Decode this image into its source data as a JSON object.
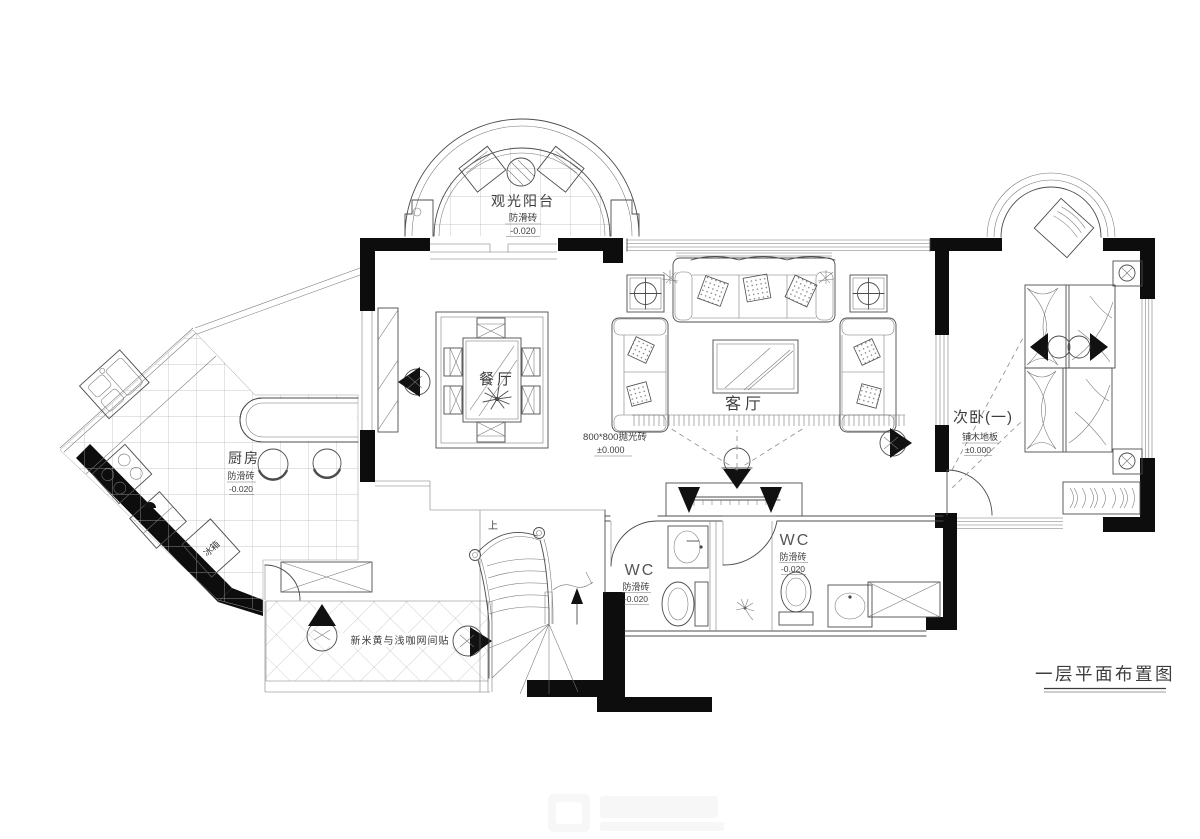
{
  "plan": {
    "title": "一层平面布置图",
    "balcony": {
      "name": "观光阳台",
      "floor": "防滑砖",
      "level": "-0.020"
    },
    "dining": {
      "name": "餐厅"
    },
    "living": {
      "name": "客厅",
      "floor": "800*800抛光砖",
      "level": "±0.000"
    },
    "bedroom": {
      "name": "次卧(一)",
      "floor": "铺木地板",
      "level": "±0.000"
    },
    "kitchen": {
      "name": "厨房",
      "floor": "防滑砖",
      "level": "-0.020",
      "fridge": "冰箱"
    },
    "wc_left": {
      "name": "WC",
      "floor": "防滑砖",
      "level": "-0.020"
    },
    "wc_right": {
      "name": "WC",
      "floor": "防滑砖",
      "level": "-0.020"
    },
    "corridor": {
      "floor_note": "新米黄与浅咖网间贴"
    },
    "stairs": {
      "up": "上"
    },
    "colors": {
      "line": "#4c4c4c",
      "wall": "#0d0d0d",
      "background": "#ffffff"
    }
  }
}
